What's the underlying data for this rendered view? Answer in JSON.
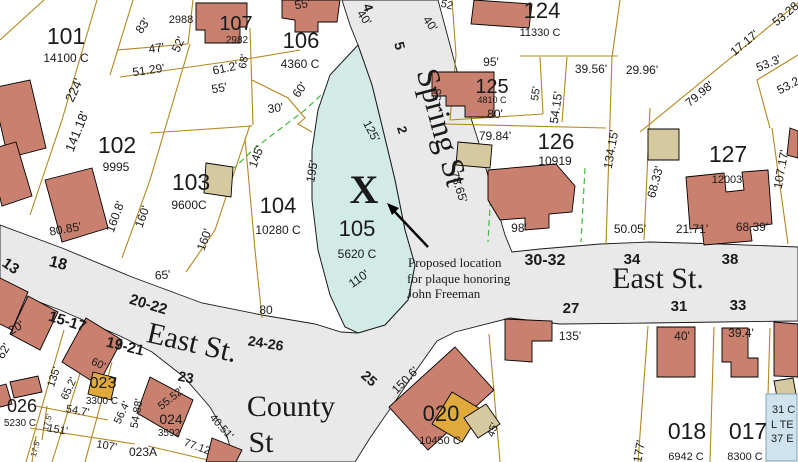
{
  "map": {
    "colors": {
      "street_gray": "#e9e9e9",
      "parcel_line": "#b3871e",
      "building_salmon": "#c9806e",
      "building_tan": "#d6c9a0",
      "building_gold": "#dfa93c",
      "highlight_teal": "#d2ebe7",
      "highlight_text": "#0e4f45",
      "dashed_green": "#3dbb3d",
      "info_box_blue": "#cfe3ef"
    },
    "annotation": {
      "line1": "Proposed location",
      "line2": "for plaque honoring",
      "line3": "John Freeman",
      "marker": "X"
    },
    "info_box": {
      "lines": [
        "31 C",
        "L TE",
        "37 E"
      ]
    },
    "streets": [
      "East St.",
      "East St.",
      "Spring St",
      "County St"
    ],
    "labels": [
      {
        "t": "101",
        "x": 66,
        "y": 44,
        "s": 23,
        "k": "id"
      },
      {
        "t": "14100 C",
        "x": 66,
        "y": 62,
        "s": 12,
        "k": "area"
      },
      {
        "t": "102",
        "x": 117,
        "y": 153,
        "s": 23,
        "k": "id"
      },
      {
        "t": "9995",
        "x": 116,
        "y": 171,
        "s": 12,
        "k": "area"
      },
      {
        "t": "103",
        "x": 191,
        "y": 190,
        "s": 23,
        "k": "id"
      },
      {
        "t": "9600C",
        "x": 189,
        "y": 209,
        "s": 12,
        "k": "area"
      },
      {
        "t": "104",
        "x": 278,
        "y": 213,
        "s": 22,
        "k": "id"
      },
      {
        "t": "10280 C",
        "x": 278,
        "y": 234,
        "s": 12,
        "k": "area"
      },
      {
        "t": "105",
        "x": 357,
        "y": 236,
        "s": 22,
        "k": "id",
        "c": "#0e4f45"
      },
      {
        "t": "5620 C",
        "x": 357,
        "y": 258,
        "s": 12,
        "k": "area",
        "c": "#0e4f45"
      },
      {
        "t": "106",
        "x": 301,
        "y": 48,
        "s": 22,
        "k": "id"
      },
      {
        "t": "4360 C",
        "x": 300,
        "y": 68,
        "s": 12,
        "k": "area"
      },
      {
        "t": "107",
        "x": 236,
        "y": 30,
        "s": 20,
        "k": "id"
      },
      {
        "t": "2982",
        "x": 237,
        "y": 43,
        "s": 10,
        "k": "area"
      },
      {
        "t": "2988",
        "x": 181,
        "y": 23,
        "s": 11,
        "k": "area"
      },
      {
        "t": "124",
        "x": 542,
        "y": 18,
        "s": 22,
        "k": "id"
      },
      {
        "t": "11330 C",
        "x": 540,
        "y": 36,
        "s": 11,
        "k": "area"
      },
      {
        "t": "125",
        "x": 492,
        "y": 93,
        "s": 20,
        "k": "id"
      },
      {
        "t": "4810 C",
        "x": 492,
        "y": 103,
        "s": 9,
        "k": "area"
      },
      {
        "t": "126",
        "x": 556,
        "y": 149,
        "s": 22,
        "k": "id"
      },
      {
        "t": "10919",
        "x": 555,
        "y": 165,
        "s": 12,
        "k": "area"
      },
      {
        "t": "127",
        "x": 728,
        "y": 162,
        "s": 23,
        "k": "id"
      },
      {
        "t": "12003",
        "x": 727,
        "y": 183,
        "s": 11,
        "k": "area"
      },
      {
        "t": "026",
        "x": 22,
        "y": 412,
        "s": 18,
        "k": "id"
      },
      {
        "t": "5230 C",
        "x": 20,
        "y": 426,
        "s": 10,
        "k": "area"
      },
      {
        "t": "023",
        "x": 103,
        "y": 388,
        "s": 16,
        "k": "id"
      },
      {
        "t": "3300 C",
        "x": 102,
        "y": 404,
        "s": 10,
        "k": "area"
      },
      {
        "t": "024",
        "x": 171,
        "y": 424,
        "s": 14,
        "k": "id"
      },
      {
        "t": "3592",
        "x": 169,
        "y": 436,
        "s": 10,
        "k": "area"
      },
      {
        "t": "023A",
        "x": 143,
        "y": 456,
        "s": 12,
        "k": "id"
      },
      {
        "t": "020",
        "x": 441,
        "y": 421,
        "s": 22,
        "k": "id"
      },
      {
        "t": "10450 C",
        "x": 440,
        "y": 444,
        "s": 11,
        "k": "area"
      },
      {
        "t": "018",
        "x": 687,
        "y": 439,
        "s": 23,
        "k": "id"
      },
      {
        "t": "6942 C",
        "x": 686,
        "y": 460,
        "s": 11,
        "k": "area"
      },
      {
        "t": "017",
        "x": 748,
        "y": 439,
        "s": 23,
        "k": "id"
      },
      {
        "t": "8300 C",
        "x": 745,
        "y": 460,
        "s": 11,
        "k": "area"
      },
      {
        "t": "13",
        "x": 8,
        "y": 270,
        "r": 35,
        "s": 15,
        "k": "stnum"
      },
      {
        "t": "18",
        "x": 57,
        "y": 268,
        "r": 14,
        "s": 16,
        "k": "stnum"
      },
      {
        "t": "20-22",
        "x": 147,
        "y": 309,
        "r": 17,
        "s": 15,
        "k": "stnum"
      },
      {
        "t": "15-17",
        "x": 66,
        "y": 326,
        "r": 17,
        "s": 15,
        "k": "stnum"
      },
      {
        "t": "19-21",
        "x": 124,
        "y": 351,
        "r": 14,
        "s": 15,
        "k": "stnum"
      },
      {
        "t": "23",
        "x": 185,
        "y": 382,
        "r": 11,
        "s": 14,
        "k": "stnum"
      },
      {
        "t": "24-26",
        "x": 265,
        "y": 348,
        "r": 9,
        "s": 14,
        "k": "stnum"
      },
      {
        "t": "25",
        "x": 366,
        "y": 382,
        "r": 42,
        "s": 14,
        "k": "stnum"
      },
      {
        "t": "27",
        "x": 571,
        "y": 313,
        "s": 15,
        "k": "stnum"
      },
      {
        "t": "30-32",
        "x": 545,
        "y": 265,
        "s": 16,
        "k": "stnum"
      },
      {
        "t": "34",
        "x": 632,
        "y": 264,
        "s": 15,
        "k": "stnum"
      },
      {
        "t": "38",
        "x": 730,
        "y": 264,
        "s": 15,
        "k": "stnum"
      },
      {
        "t": "31",
        "x": 679,
        "y": 311,
        "s": 15,
        "k": "stnum"
      },
      {
        "t": "33",
        "x": 738,
        "y": 310,
        "s": 15,
        "k": "stnum"
      },
      {
        "t": "4",
        "x": 364,
        "y": 9,
        "r": 70,
        "s": 13,
        "k": "stnum"
      },
      {
        "t": "5",
        "x": 395,
        "y": 47,
        "r": 75,
        "s": 14,
        "k": "stnum"
      },
      {
        "t": "2",
        "x": 398,
        "y": 131,
        "r": 75,
        "s": 13,
        "k": "stnum"
      },
      {
        "t": "East St.",
        "x": 658,
        "y": 288,
        "s": 30,
        "k": "stname"
      },
      {
        "t": "East St.",
        "x": 190,
        "y": 352,
        "r": 13,
        "s": 30,
        "k": "stname"
      },
      {
        "t": "Spring St",
        "x": 432,
        "y": 130,
        "r": 75,
        "s": 32,
        "k": "stname"
      },
      {
        "t": "County",
        "x": 291,
        "y": 416,
        "s": 30,
        "k": "stname"
      },
      {
        "t": "St",
        "x": 261,
        "y": 452,
        "s": 30,
        "k": "stname"
      },
      {
        "t": "83'",
        "x": 146,
        "y": 28,
        "r": -55,
        "s": 12,
        "k": "dim"
      },
      {
        "t": "47'",
        "x": 157,
        "y": 52,
        "r": -8,
        "s": 12,
        "k": "dim"
      },
      {
        "t": "52'",
        "x": 182,
        "y": 46,
        "r": -65,
        "s": 12,
        "k": "dim"
      },
      {
        "t": "51.29'",
        "x": 149,
        "y": 74,
        "r": -8,
        "s": 12,
        "k": "dim"
      },
      {
        "t": "61.2'",
        "x": 226,
        "y": 72,
        "r": -12,
        "s": 12,
        "k": "dim"
      },
      {
        "t": "55'",
        "x": 220,
        "y": 92,
        "r": -10,
        "s": 12,
        "k": "dim"
      },
      {
        "t": "68'",
        "x": 247,
        "y": 62,
        "r": -80,
        "s": 11,
        "k": "dim"
      },
      {
        "t": "224'",
        "x": 78,
        "y": 92,
        "r": -65,
        "s": 13,
        "k": "dim"
      },
      {
        "t": "141.18'",
        "x": 81,
        "y": 133,
        "r": -68,
        "s": 13,
        "k": "dim"
      },
      {
        "t": "55'",
        "x": 303,
        "y": 8,
        "r": -10,
        "s": 12,
        "k": "dim"
      },
      {
        "t": "40'",
        "x": 361,
        "y": 20,
        "r": 55,
        "s": 12,
        "k": "dim"
      },
      {
        "t": "60'",
        "x": 303,
        "y": 92,
        "r": -55,
        "s": 12,
        "k": "dim"
      },
      {
        "t": "30'",
        "x": 276,
        "y": 112,
        "r": -8,
        "s": 12,
        "k": "dim"
      },
      {
        "t": "145'",
        "x": 260,
        "y": 158,
        "r": -70,
        "s": 12,
        "k": "dim"
      },
      {
        "t": "160.8'",
        "x": 119,
        "y": 218,
        "r": -70,
        "s": 12,
        "k": "dim"
      },
      {
        "t": "160'",
        "x": 146,
        "y": 218,
        "r": -70,
        "s": 12,
        "k": "dim"
      },
      {
        "t": "160'",
        "x": 208,
        "y": 241,
        "r": -70,
        "s": 12,
        "k": "dim"
      },
      {
        "t": "80.85'",
        "x": 66,
        "y": 233,
        "r": -10,
        "s": 12,
        "k": "dim"
      },
      {
        "t": "195'",
        "x": 316,
        "y": 172,
        "r": -80,
        "s": 12,
        "k": "dim"
      },
      {
        "t": "65'",
        "x": 163,
        "y": 279,
        "r": -5,
        "s": 12,
        "k": "dim"
      },
      {
        "t": "80",
        "x": 266,
        "y": 314,
        "s": 12,
        "k": "dim"
      },
      {
        "t": "125'",
        "x": 368,
        "y": 133,
        "r": 62,
        "s": 12,
        "k": "dim"
      },
      {
        "t": "110'",
        "x": 361,
        "y": 282,
        "r": -35,
        "s": 12,
        "k": "dim"
      },
      {
        "t": "52",
        "x": 446,
        "y": 8,
        "r": 15,
        "s": 11,
        "k": "dim"
      },
      {
        "t": "40'",
        "x": 427,
        "y": 26,
        "r": 55,
        "s": 12,
        "k": "dim"
      },
      {
        "t": "95'",
        "x": 491,
        "y": 66,
        "s": 12,
        "k": "dim"
      },
      {
        "t": "55'",
        "x": 441,
        "y": 94,
        "r": -85,
        "s": 11,
        "k": "dim"
      },
      {
        "t": "80'",
        "x": 495,
        "y": 118,
        "s": 12,
        "k": "dim"
      },
      {
        "t": "39.56'",
        "x": 591,
        "y": 73,
        "s": 12,
        "k": "dim"
      },
      {
        "t": "29.96'",
        "x": 642,
        "y": 74,
        "s": 12,
        "k": "dim"
      },
      {
        "t": "55'",
        "x": 539,
        "y": 94,
        "r": -82,
        "s": 11,
        "k": "dim"
      },
      {
        "t": "54.15'",
        "x": 560,
        "y": 108,
        "r": -82,
        "s": 12,
        "k": "dim"
      },
      {
        "t": "134.15'",
        "x": 615,
        "y": 150,
        "r": -80,
        "s": 12,
        "k": "dim"
      },
      {
        "t": "79.84'",
        "x": 495,
        "y": 140,
        "s": 12,
        "k": "dim"
      },
      {
        "t": "78.65'",
        "x": 455,
        "y": 188,
        "r": 72,
        "s": 12,
        "k": "dim"
      },
      {
        "t": "98'",
        "x": 519,
        "y": 232,
        "s": 12,
        "k": "dim"
      },
      {
        "t": "50.05'",
        "x": 630,
        "y": 233,
        "s": 12,
        "k": "dim"
      },
      {
        "t": "68.33'",
        "x": 659,
        "y": 183,
        "r": -75,
        "s": 12,
        "k": "dim"
      },
      {
        "t": "21.71'",
        "x": 692,
        "y": 233,
        "s": 12,
        "k": "dim"
      },
      {
        "t": "68.39'",
        "x": 752,
        "y": 231,
        "s": 12,
        "k": "dim"
      },
      {
        "t": "107.17'",
        "x": 785,
        "y": 170,
        "r": -80,
        "s": 12,
        "k": "dim"
      },
      {
        "t": "79.98'",
        "x": 702,
        "y": 97,
        "r": -40,
        "s": 12,
        "k": "dim"
      },
      {
        "t": "17.17'",
        "x": 747,
        "y": 46,
        "r": -40,
        "s": 12,
        "k": "dim"
      },
      {
        "t": "53.28",
        "x": 788,
        "y": 17,
        "r": -40,
        "s": 12,
        "k": "dim"
      },
      {
        "t": "53.3'",
        "x": 770,
        "y": 67,
        "r": -22,
        "s": 12,
        "k": "dim"
      },
      {
        "t": "53.2",
        "x": 790,
        "y": 89,
        "r": -28,
        "s": 12,
        "k": "dim"
      },
      {
        "t": "135'",
        "x": 570,
        "y": 340,
        "s": 12,
        "k": "dim"
      },
      {
        "t": "40'",
        "x": 682,
        "y": 340,
        "s": 12,
        "k": "dim"
      },
      {
        "t": "39.4'",
        "x": 741,
        "y": 337,
        "s": 12,
        "k": "dim"
      },
      {
        "t": "150.6'",
        "x": 408,
        "y": 383,
        "r": -45,
        "s": 12,
        "k": "dim"
      },
      {
        "t": "45'",
        "x": 496,
        "y": 431,
        "r": -70,
        "s": 11,
        "k": "dim"
      },
      {
        "t": "177'",
        "x": 643,
        "y": 452,
        "r": -80,
        "s": 12,
        "k": "dim"
      },
      {
        "t": "20'",
        "x": 18,
        "y": 331,
        "r": -30,
        "s": 12,
        "k": "dim"
      },
      {
        "t": "62'",
        "x": 7,
        "y": 353,
        "r": -60,
        "s": 12,
        "k": "dim"
      },
      {
        "t": "135'",
        "x": 57,
        "y": 378,
        "r": -72,
        "s": 11,
        "k": "dim"
      },
      {
        "t": "65.2'",
        "x": 72,
        "y": 390,
        "r": -65,
        "s": 11,
        "k": "dim"
      },
      {
        "t": "54.7'",
        "x": 77,
        "y": 414,
        "r": 10,
        "s": 11,
        "k": "dim"
      },
      {
        "t": "151'",
        "x": 57,
        "y": 433,
        "r": 10,
        "s": 11,
        "k": "dim"
      },
      {
        "t": "107'",
        "x": 106,
        "y": 449,
        "r": 10,
        "s": 11,
        "k": "dim"
      },
      {
        "t": "56.4'",
        "x": 125,
        "y": 414,
        "r": -65,
        "s": 11,
        "k": "dim"
      },
      {
        "t": "55.52'",
        "x": 173,
        "y": 401,
        "r": -38,
        "s": 11,
        "k": "dim"
      },
      {
        "t": "54.88'",
        "x": 140,
        "y": 414,
        "r": -80,
        "s": 11,
        "k": "dim"
      },
      {
        "t": "40.51'",
        "x": 219,
        "y": 429,
        "r": 48,
        "s": 11,
        "k": "dim"
      },
      {
        "t": "77.12",
        "x": 196,
        "y": 450,
        "r": 20,
        "s": 11,
        "k": "dim"
      },
      {
        "t": "17.5'",
        "x": 50,
        "y": 423,
        "r": -75,
        "s": 8,
        "k": "dim"
      },
      {
        "t": "17.5'",
        "x": 38,
        "y": 449,
        "r": -75,
        "s": 8,
        "k": "dim"
      },
      {
        "t": "60'",
        "x": 97,
        "y": 367,
        "r": 25,
        "s": 11,
        "k": "dim"
      },
      {
        "t": "Proposed location",
        "x": 408,
        "y": 267,
        "s": 13,
        "k": "ann",
        "a": "s"
      },
      {
        "t": "for plaque honoring",
        "x": 407,
        "y": 283,
        "s": 13,
        "k": "ann",
        "a": "s"
      },
      {
        "t": "John Freeman",
        "x": 407,
        "y": 298,
        "s": 13,
        "k": "ann",
        "a": "s"
      },
      {
        "t": "X",
        "x": 364,
        "y": 203,
        "s": 40,
        "k": "marker"
      },
      {
        "t": "31 C",
        "x": 772,
        "y": 413,
        "s": 11,
        "k": "box",
        "a": "s"
      },
      {
        "t": "L TE",
        "x": 771,
        "y": 428,
        "s": 11,
        "k": "box",
        "a": "s"
      },
      {
        "t": "37 E",
        "x": 771,
        "y": 442,
        "s": 11,
        "k": "box",
        "a": "s"
      }
    ]
  }
}
